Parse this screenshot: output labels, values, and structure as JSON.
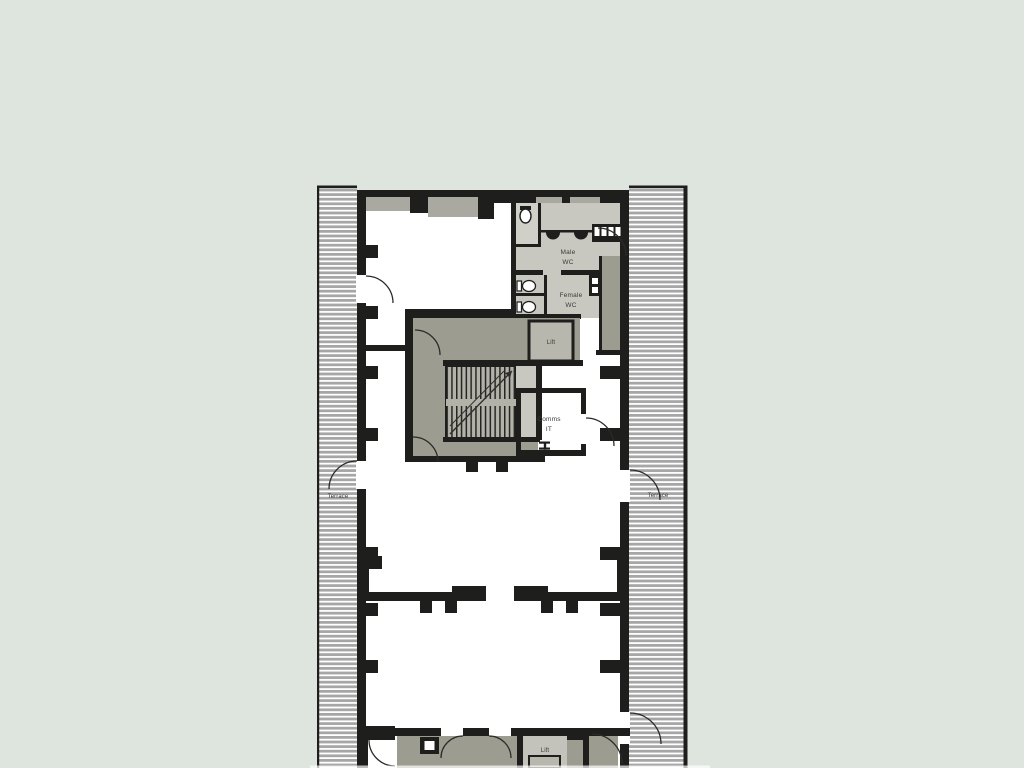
{
  "meta": {
    "width": 1024,
    "height": 768,
    "description_hint": "architectural floor plan centered on pale sage background"
  },
  "background_color": "#dee5df",
  "plan": {
    "colors": {
      "wall": "#1e1e1c",
      "core_gray": "#9c9c91",
      "room_gray": "#c8c8c1",
      "lift_inner_gray": "#b7b7ae",
      "hatch_gray": "#a6a6a6",
      "facade_recess_gray": "#a9a9a1",
      "label_text": "#3a3a38"
    },
    "labels": {
      "terrace_left": "Terrace",
      "terrace_right": "Terrace",
      "male_wc_line1": "Male",
      "male_wc_line2": "WC",
      "female_wc_line1": "Female",
      "female_wc_line2": "WC",
      "lift_upper": "Lift",
      "comms_line1": "Comms",
      "comms_line2": "IT",
      "lift_lower": "Lift"
    }
  }
}
